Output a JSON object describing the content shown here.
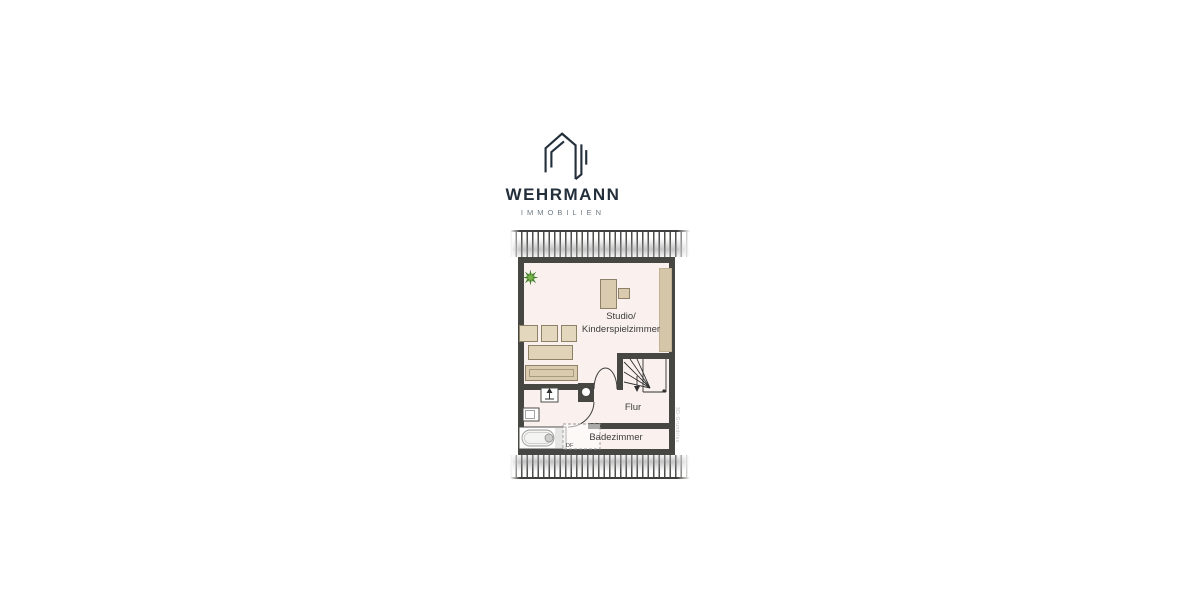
{
  "logo": {
    "brand": "WEHRMANN",
    "tagline": "IMMOBILIEN",
    "icon": "house-outline-icon",
    "brand_color": "#232f3b",
    "tagline_color": "#6e7a84"
  },
  "floorplan": {
    "rooms": [
      {
        "name": "studio",
        "label_line1": "Studio/",
        "label_line2": "Kinderspielzimmer"
      },
      {
        "name": "flur",
        "label": "Flur"
      },
      {
        "name": "badezimmer",
        "label": "Badezimmer"
      }
    ],
    "annotations": {
      "roof_window_label": "DF",
      "watermark": "3D-Grundriss"
    },
    "symbols": [
      "potted-plant",
      "desk",
      "chair",
      "wardrobe",
      "sofa-cushions",
      "coffee-table",
      "sideboard",
      "vent-arrow-box",
      "washbasin",
      "bathtub",
      "roof-window",
      "winder-stairs",
      "chimney",
      "door-swing-arcs",
      "roof-slope-hatching"
    ],
    "colors": {
      "wall": "#464642",
      "floor": "#faf1ee",
      "furniture_fill": "#dbcbae",
      "furniture_border": "#8d8168",
      "plant_green": "#4a8a33",
      "hatch_line": "#4d4d4b"
    }
  }
}
